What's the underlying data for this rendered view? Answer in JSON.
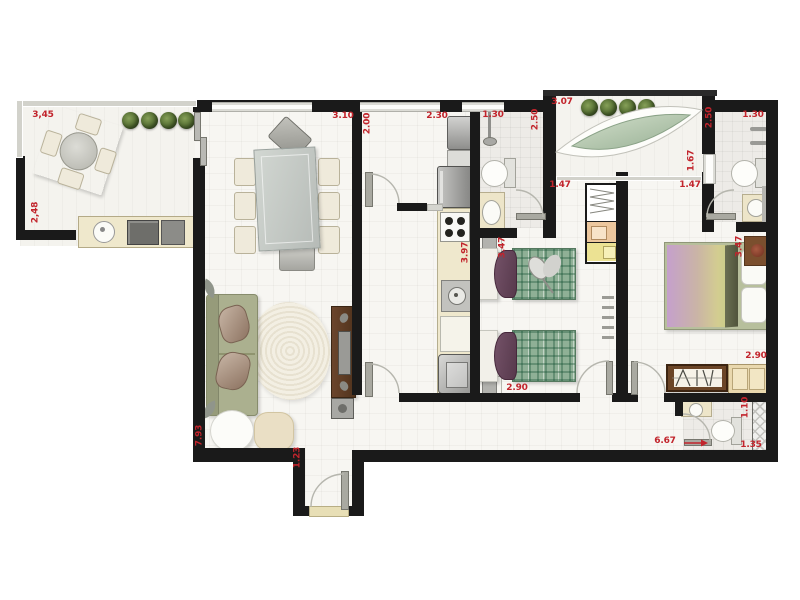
{
  "title": "apartment-floor-plan",
  "colors": {
    "wall": "#1a1a1a",
    "dimension_text": "#c2242c",
    "bed_plaid": "#7ea88a",
    "sofa": "#abb08f"
  },
  "dims": {
    "balcony_left_width": "3,45",
    "balcony_left_depth": "2,48",
    "dining_width": "3.10",
    "service_depth": "2.00",
    "service_width": "2.30",
    "bath_top_width": "1.30",
    "bath_top_depth": "2.50",
    "balcony_right_width": "3.07",
    "balcony_right_depth": "2.50",
    "balcony_right_window": "1.67",
    "closet_left_width": "1.47",
    "closet_right_width": "1.47",
    "bath_right_width": "1.30",
    "kids_room_length": "3.47",
    "kids_room_width": "2.90",
    "master_room_length": "3.47",
    "master_room_width": "2.90",
    "kitchen_length": "3.97",
    "living_length": "7.93",
    "entry_width": "1.23",
    "hall_length": "6.67",
    "lavabo_depth": "1.10",
    "lavabo_width": "1.35"
  }
}
